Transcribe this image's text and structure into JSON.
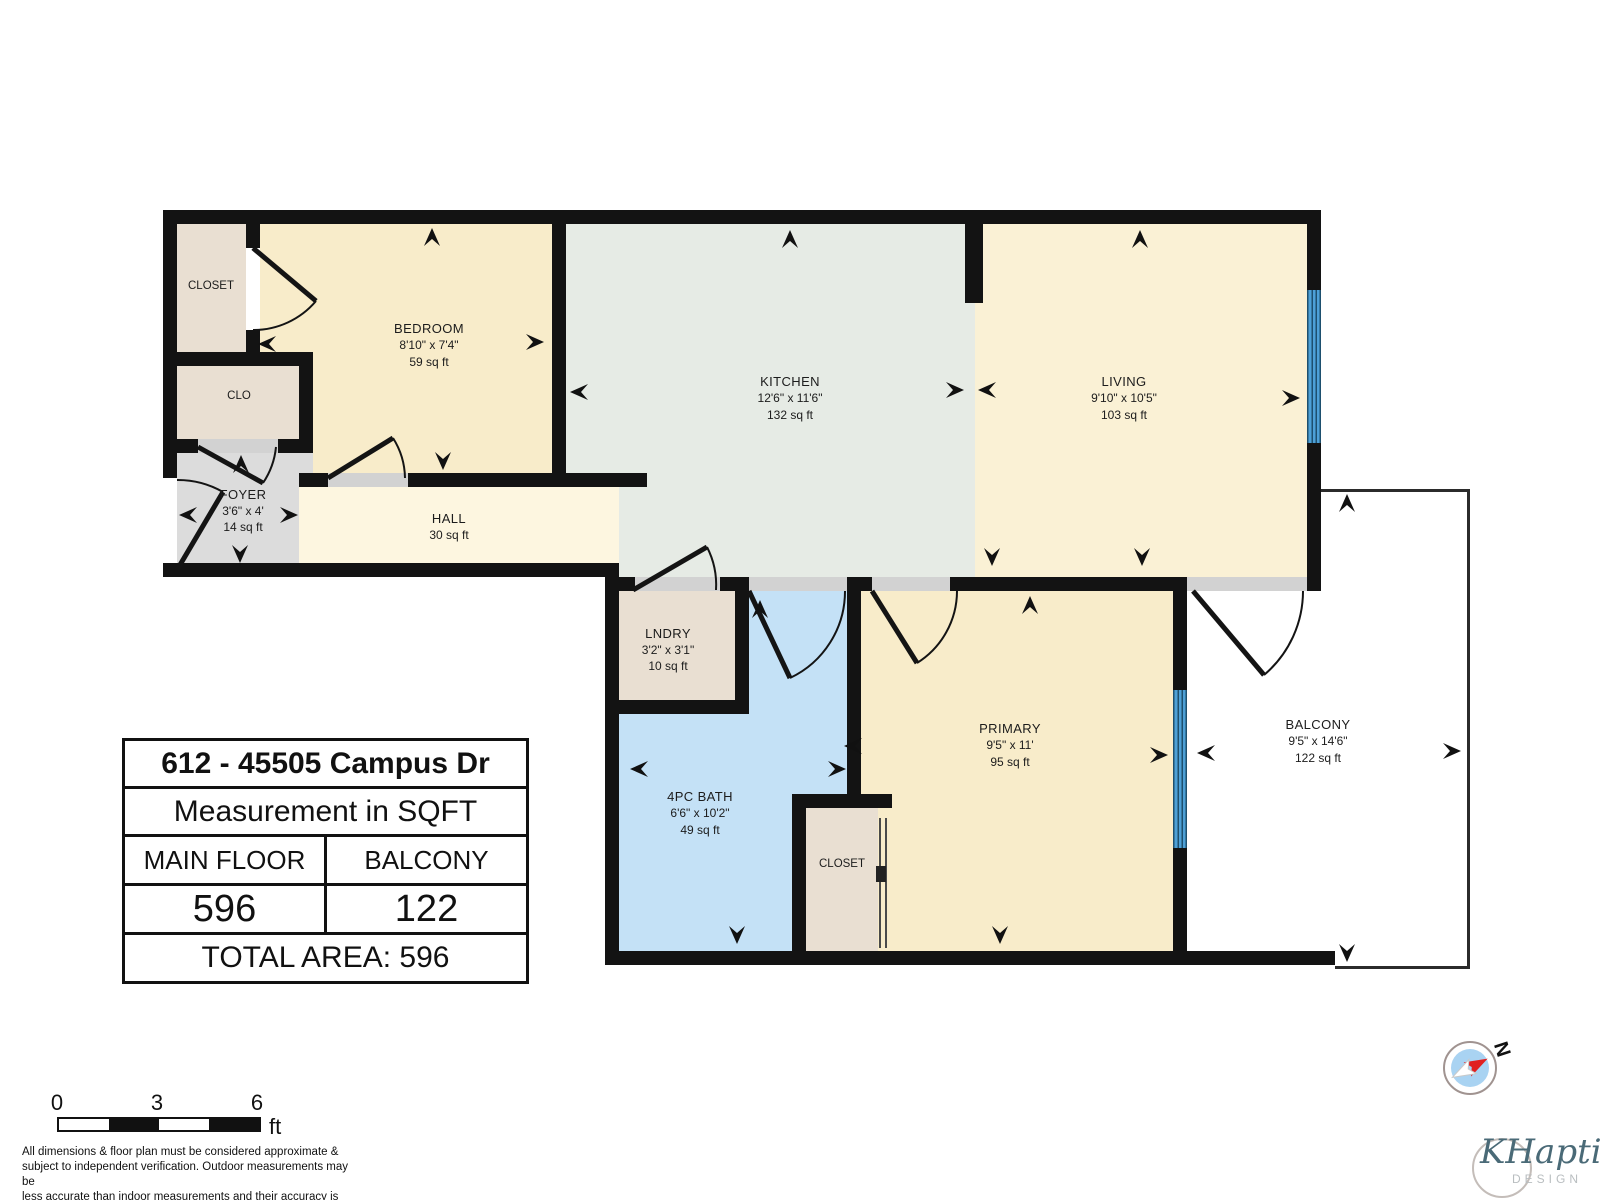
{
  "plan": {
    "rooms": {
      "closet_tl": {
        "name": "CLOSET"
      },
      "bedroom": {
        "name": "BEDROOM",
        "dims": "8'10\" x 7'4\"",
        "area": "59 sq ft"
      },
      "kitchen": {
        "name": "KITCHEN",
        "dims": "12'6\" x 11'6\"",
        "area": "132 sq ft"
      },
      "living": {
        "name": "LIVING",
        "dims": "9'10\" x 10'5\"",
        "area": "103 sq ft"
      },
      "clo": {
        "name": "CLO"
      },
      "foyer": {
        "name": "FOYER",
        "dims": "3'6\" x 4'",
        "area": "14 sq ft"
      },
      "hall": {
        "name": "HALL",
        "area": "30 sq ft"
      },
      "lndry": {
        "name": "LNDRY",
        "dims": "3'2\" x 3'1\"",
        "area": "10 sq ft"
      },
      "bath": {
        "name": "4PC BATH",
        "dims": "6'6\" x 10'2\"",
        "area": "49 sq ft"
      },
      "primary": {
        "name": "PRIMARY",
        "dims": "9'5\" x 11'",
        "area": "95 sq ft"
      },
      "closet_primary": {
        "name": "CLOSET"
      },
      "balcony": {
        "name": "BALCONY",
        "dims": "9'5\" x 14'6\"",
        "area": "122 sq ft"
      }
    },
    "colors": {
      "wall": "#131313",
      "cream_room": "#f8ecca",
      "living_room": "#faf1d5",
      "hall": "#fdf6e0",
      "kitchen": "#e6ebe5",
      "bath": "#c4e1f6",
      "closet": "#e9dfd2",
      "foyer": "#dcdcdc",
      "window": "#4da0d7",
      "door_sill": "#d2d2d2"
    }
  },
  "info_table": {
    "address": "612 - 45505 Campus Dr",
    "subtitle": "Measurement in SQFT",
    "col1_header": "MAIN FLOOR",
    "col2_header": "BALCONY",
    "col1_value": "596",
    "col2_value": "122",
    "total": "TOTAL AREA: 596"
  },
  "scale_bar": {
    "tick0": "0",
    "tick1": "3",
    "tick2": "6",
    "unit": "ft"
  },
  "disclaimer": "All dimensions & floor plan must be considered approximate &\nsubject to independent verification.  Outdoor measurements may be\nless accurate than indoor measurements and their accuracy is not\nguaranteed.",
  "compass": {
    "north_label": "N"
  },
  "watermark": {
    "name": "KHaptive",
    "sub": "DESIGN"
  }
}
